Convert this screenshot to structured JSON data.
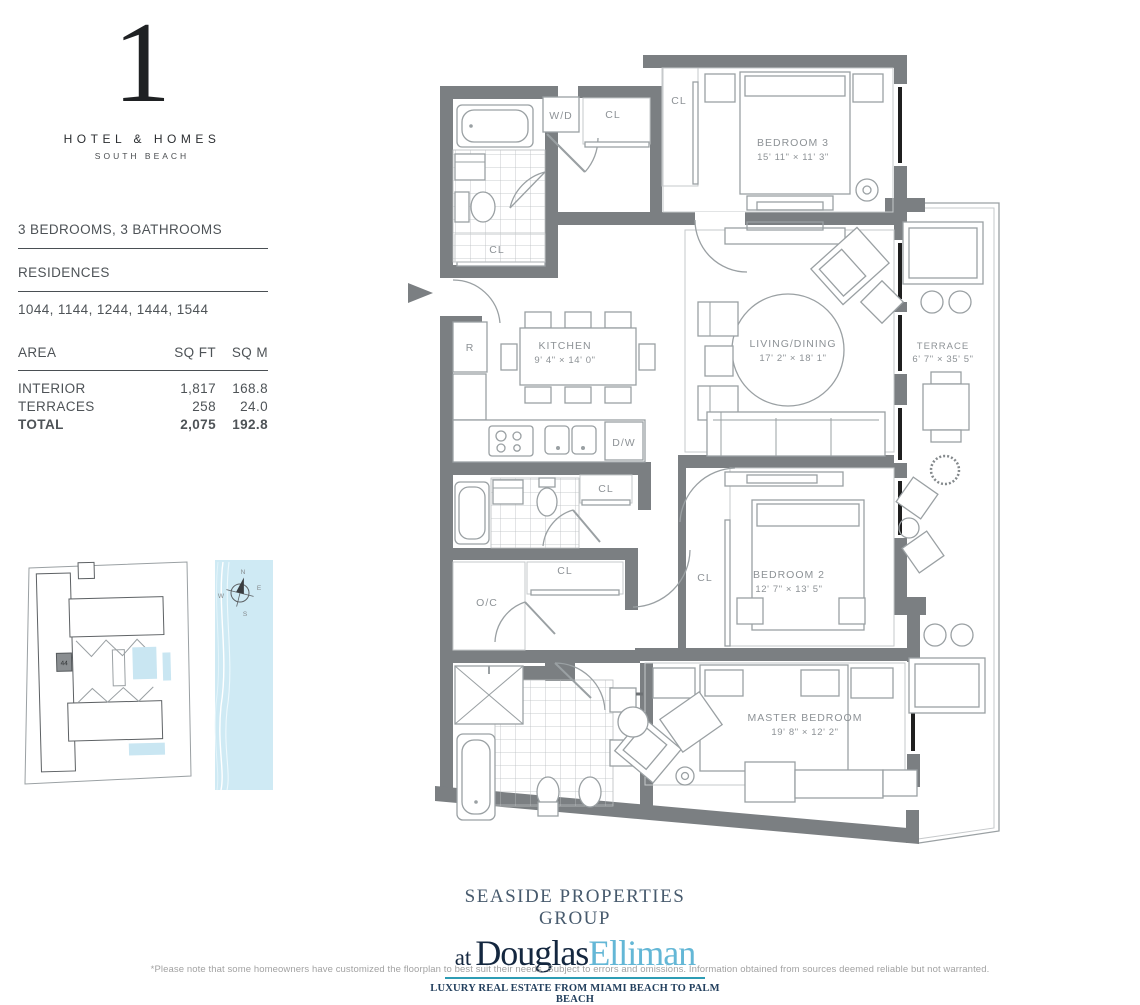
{
  "logo": {
    "numeral": "1",
    "brand": "HOTEL & HOMES",
    "sub": "SOUTH BEACH"
  },
  "unit_info": {
    "beds_baths": "3 BEDROOMS, 3 BATHROOMS",
    "residences_label": "RESIDENCES",
    "residences": "1044, 1144, 1244, 1444, 1544"
  },
  "area_table": {
    "col_area": "AREA",
    "col_sqft": "SQ FT",
    "col_sqm": "SQ M",
    "rows": [
      {
        "label": "INTERIOR",
        "sqft": "1,817",
        "sqm": "168.8"
      },
      {
        "label": "TERRACES",
        "sqft": "258",
        "sqm": "24.0"
      },
      {
        "label": "TOTAL",
        "sqft": "2,075",
        "sqm": "192.8"
      }
    ]
  },
  "keyplan": {
    "unit": "44",
    "compass": {
      "n": "N",
      "e": "E",
      "s": "S",
      "w": "W"
    }
  },
  "floorplan": {
    "rooms": [
      {
        "name": "BEDROOM 3",
        "dims": "15' 11\" × 11' 3\""
      },
      {
        "name": "KITCHEN",
        "dims": "9' 4\" × 14' 0\""
      },
      {
        "name": "LIVING/DINING",
        "dims": "17' 2\" × 18' 1\""
      },
      {
        "name": "TERRACE",
        "dims": "6' 7\" × 35' 5\""
      },
      {
        "name": "BEDROOM 2",
        "dims": "12' 7\" × 13' 5\""
      },
      {
        "name": "MASTER BEDROOM",
        "dims": "19' 8\" × 12' 2\""
      }
    ],
    "labels": {
      "wd": "W/D",
      "cl": "CL",
      "r": "R",
      "dw": "D/W",
      "oc": "O/C"
    }
  },
  "branding": {
    "group": "SEASIDE PROPERTIES GROUP",
    "at": "at",
    "douglas": "Douglas",
    "elliman": "Elliman",
    "tagline": "LUXURY REAL ESTATE FROM MIAMI BEACH TO PALM BEACH"
  },
  "disclaimer": "*Please note that some homeowners have customized the floorplan to best suit their needs. Subject to errors and omissions. Information obtained from sources deemed reliable but not warranted.",
  "colors": {
    "wall": "#7b7f82",
    "accent_teal": "#2d9cb4",
    "elliman_blue": "#64b7d6",
    "water": "#cfeaf4"
  }
}
